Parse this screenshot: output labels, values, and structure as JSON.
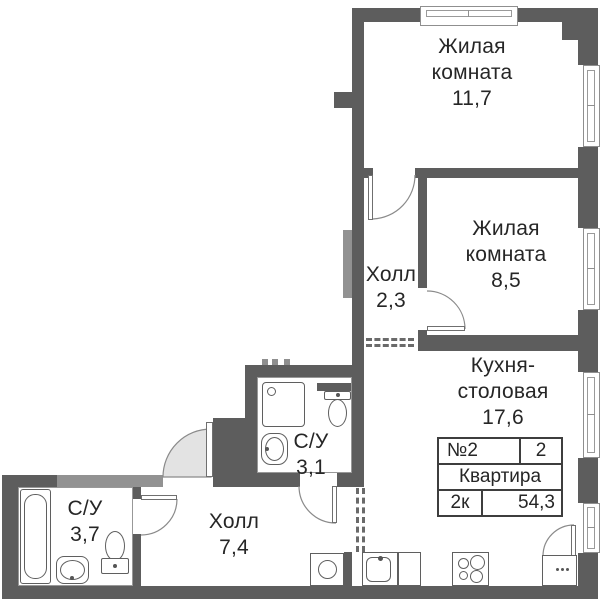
{
  "rooms": {
    "living1": {
      "name": "Жилая комната",
      "area": "11,7"
    },
    "living2": {
      "name": "Жилая комната",
      "area": "8,5"
    },
    "hall_small": {
      "name": "Холл",
      "area": "2,3"
    },
    "kitchen": {
      "name": "Кухня-столовая",
      "area": "17,6"
    },
    "bath_small": {
      "name": "С/У",
      "area": "3,1"
    },
    "hall_main": {
      "name": "Холл",
      "area": "7,4"
    },
    "bath_main": {
      "name": "С/У",
      "area": "3,7"
    }
  },
  "info_table": {
    "flat_number": "№2",
    "rooms_count": "2",
    "flat_label": "Квартира",
    "flat_type": "2к",
    "total_area": "54,3"
  },
  "colors": {
    "wall": "#5d5d5d",
    "wall_light": "#929292",
    "door_fill": "#e3e3e3",
    "text": "#262626"
  }
}
